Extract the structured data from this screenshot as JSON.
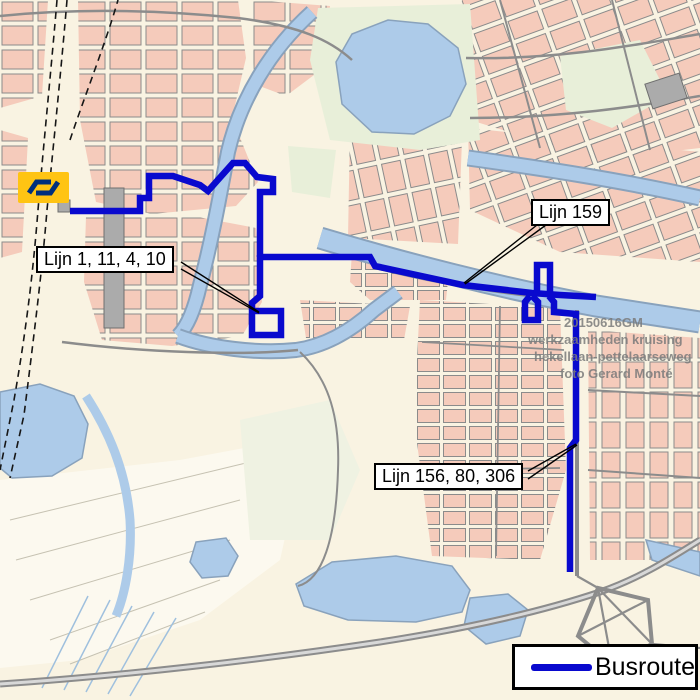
{
  "legend": {
    "label": "Busroute"
  },
  "callouts": {
    "lijn_center": {
      "label": "Lijn 1, 11, 4, 10"
    },
    "lijn_159": {
      "label": "Lijn 159"
    },
    "lijn_156": {
      "label": "Lijn 156, 80, 306"
    }
  },
  "watermark": {
    "line1": "20150616GM",
    "line2": "werkzaamheden kruising",
    "line3": "hekellaan-pettelaarseweg",
    "line4": "foto Gerard Monté"
  },
  "colors": {
    "route_blue": "#0909CE",
    "water_blue": "#ADCBE9",
    "building_pink": "#F5CBBB",
    "background_cream": "#F9F3E2",
    "park_green": "#E8EFD9",
    "road_gray": "#8C8C8C",
    "ns_yellow": "#FFC413",
    "ns_navy": "#002F7D"
  }
}
